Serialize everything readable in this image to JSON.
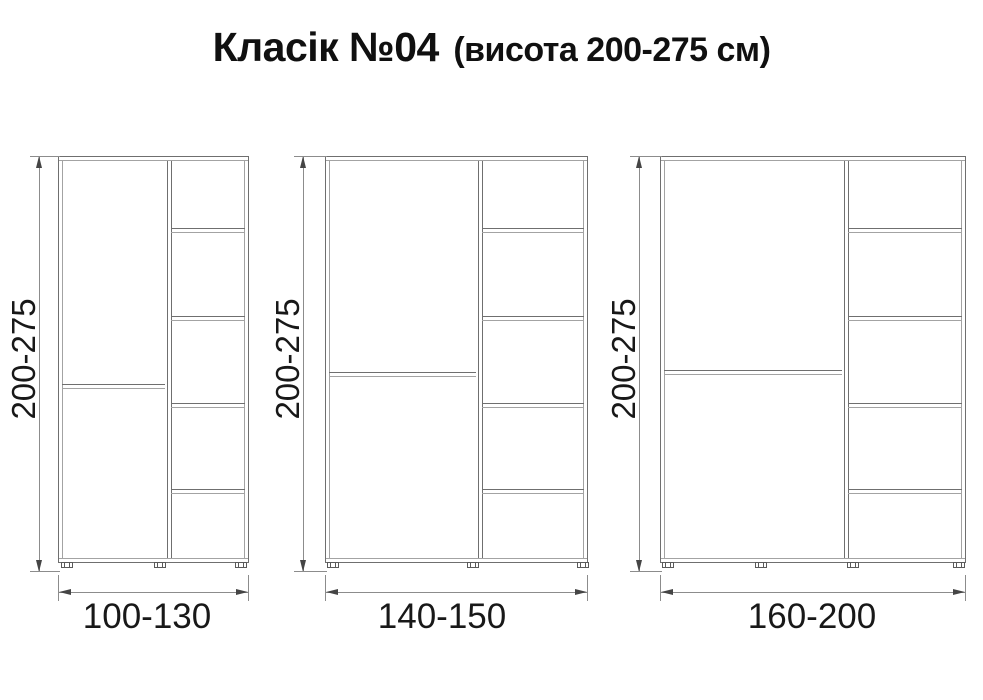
{
  "title": {
    "main": "Класік №04",
    "sub": "(висота 200-275 см)"
  },
  "diagram": {
    "cabinets": [
      {
        "id": "cabinet-1",
        "height_label": "200-275",
        "width_label": "100-130",
        "geometry": {
          "left": 58,
          "width": 191,
          "divider_x": 110,
          "door_split_frac": 0.563,
          "feet_centers": [
            8,
            101,
            182
          ],
          "dim_line_x": 39,
          "width_label_center_x": 147
        }
      },
      {
        "id": "cabinet-2",
        "height_label": "200-275",
        "width_label": "140-150",
        "geometry": {
          "left": 325,
          "width": 263,
          "divider_x": 154,
          "door_split_frac": 0.533,
          "feet_centers": [
            7,
            147,
            257
          ],
          "dim_line_x": 303,
          "width_label_center_x": 442
        }
      },
      {
        "id": "cabinet-3",
        "height_label": "200-275",
        "width_label": "160-200",
        "geometry": {
          "left": 660,
          "width": 306,
          "divider_x": 185,
          "door_split_frac": 0.528,
          "feet_centers": [
            7,
            100,
            192,
            298
          ],
          "dim_line_x": 639,
          "width_label_center_x": 812
        }
      }
    ],
    "common": {
      "top": 156,
      "body_height": 407,
      "shelf_fracs": [
        0.179,
        0.396,
        0.609,
        0.821
      ],
      "v_dim_top": 156,
      "v_dim_bottom": 572,
      "v_label_center_y": 359,
      "h_dim_y": 592,
      "width_label_top": 597
    },
    "colors": {
      "cabinet_line": "#6f6f6f",
      "cabinet_line_light": "#a3a3a3",
      "dim_line": "#8c8c8c",
      "arrow": "#454545",
      "foot": "#5a5a5a",
      "text": "#121212"
    }
  }
}
